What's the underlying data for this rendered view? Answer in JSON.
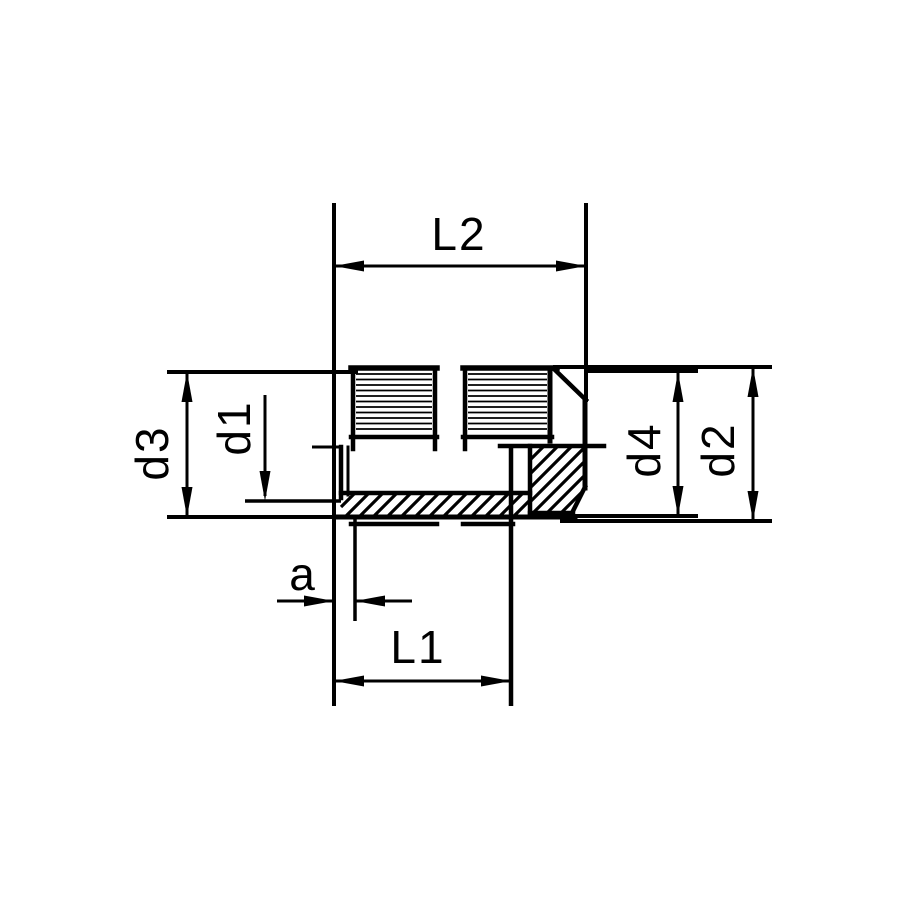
{
  "colors": {
    "background": "#ffffff",
    "line": "#000000"
  },
  "dimensions": {
    "l2": {
      "label": "L2"
    },
    "l1": {
      "label": "L1"
    },
    "a": {
      "label": "a"
    },
    "d1": {
      "label": "d1"
    },
    "d2": {
      "label": "d2"
    },
    "d3": {
      "label": "d3"
    },
    "d4": {
      "label": "d4"
    }
  }
}
